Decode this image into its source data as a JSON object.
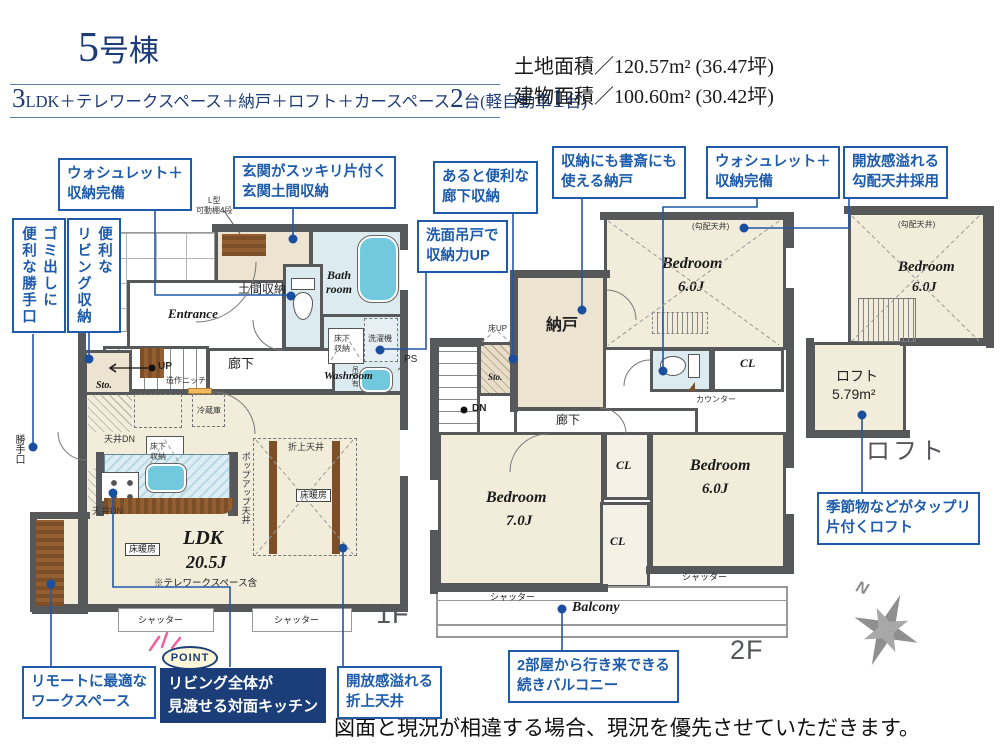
{
  "colors": {
    "callout_blue": "#1e5cab",
    "navy_box": "#1c3e78",
    "wall": "#57585a",
    "room_cream": "#f2ecda",
    "room_beige": "#ece3d1",
    "water_blue": "#dcebf0",
    "tub_blue": "#72c9de",
    "wood_brown": "#7d4f28",
    "point_badge_bg": "#fdf6d8",
    "sparkle_pink": "#f2619b"
  },
  "header": {
    "title_num": "5",
    "title_suffix": "号棟",
    "spec_num1": "3",
    "spec_mid": "LDK＋テレワークスペース＋納戸＋ロフト＋カースペース",
    "spec_num2": "2",
    "spec_tail1": "台(軽自動車",
    "spec_num3": "1",
    "spec_tail2": "台)",
    "land_area": "土地面積／120.57m² (36.47坪)",
    "building_area": "建物面積／100.60m² (30.42坪)"
  },
  "callouts": {
    "washlet_1f": {
      "lines": [
        "ウォシュレット＋",
        "収納完備"
      ]
    },
    "genkan_doma": {
      "lines": [
        "玄関がスッキリ片付く",
        "玄関土間収納"
      ]
    },
    "rouka_shuno": {
      "lines": [
        "あると便利な",
        "廊下収納"
      ]
    },
    "nando": {
      "lines": [
        "収納にも書斎にも",
        "使える納戸"
      ]
    },
    "washlet_2f": {
      "lines": [
        "ウォシュレット＋",
        "収納完備"
      ]
    },
    "koubai_tenjo": {
      "lines": [
        "開放感溢れる",
        "勾配天井採用"
      ]
    },
    "senmen": {
      "lines": [
        "洗面吊戸で",
        "収納力UP"
      ]
    },
    "gomi": {
      "col1": "ゴミ出しに",
      "col2": "便利な勝手口"
    },
    "living_shuno": {
      "col1": "便利な",
      "col2": "リビング収納"
    },
    "remote": {
      "lines": [
        "リモートに最適な",
        "ワークスペース"
      ]
    },
    "point": {
      "badge": "POINT",
      "lines": [
        "リビング全体が",
        "見渡せる対面キッチン"
      ]
    },
    "oriage": {
      "lines": [
        "開放感溢れる",
        "折上天井"
      ]
    },
    "balcony": {
      "lines": [
        "2部屋から行き来できる",
        "続きバルコニー"
      ]
    },
    "loft": {
      "lines": [
        "季節物などがタップリ",
        "片付くロフト"
      ]
    }
  },
  "f1": {
    "label": "1F",
    "doma": "土間収納",
    "shelf_note1": "L型",
    "shelf_note2": "可動棚4段",
    "bath1": "Bath",
    "bath2": "room",
    "entrance": "Entrance",
    "washroom": "Washroom",
    "yukashita1": "床下",
    "yukashita2": "収納",
    "sentakuki": "洗濯機",
    "tsurido": "吊戸有",
    "ps": "PS",
    "rouka": "廊下",
    "niche": "造作ニッチ",
    "up": "UP",
    "sto": "Sto.",
    "reizouko": "冷蔵庫",
    "tenjo_dn": "天井DN",
    "popup": "ポップアップ天井",
    "oriage": "折上天井",
    "yukadanbo": "床暖房",
    "ldk": "LDK",
    "ldk_size": "20.5J",
    "telework": "※テレワークスペース含",
    "kattekuchi": "勝手口",
    "shutter": "シャッター"
  },
  "f2": {
    "label": "2F",
    "nando": "納戸",
    "yuka_up": "床UP",
    "sto": "Sto.",
    "dn": "DN",
    "rouka": "廊下",
    "counter": "カウンター",
    "cl": "CL",
    "bedroom": "Bedroom",
    "size6": "6.0J",
    "size7": "7.0J",
    "koubai": "(勾配天井)",
    "balcony": "Balcony",
    "shutter": "シャッター"
  },
  "loft": {
    "koubai": "(勾配天井)",
    "bedroom": "Bedroom",
    "size": "6.0J",
    "name": "ロフト",
    "area": "5.79m²",
    "caption": "ロフト"
  },
  "footer": {
    "disclaimer": "図面と現況が相違する場合、現況を優先させていただきます。",
    "north": "N"
  }
}
